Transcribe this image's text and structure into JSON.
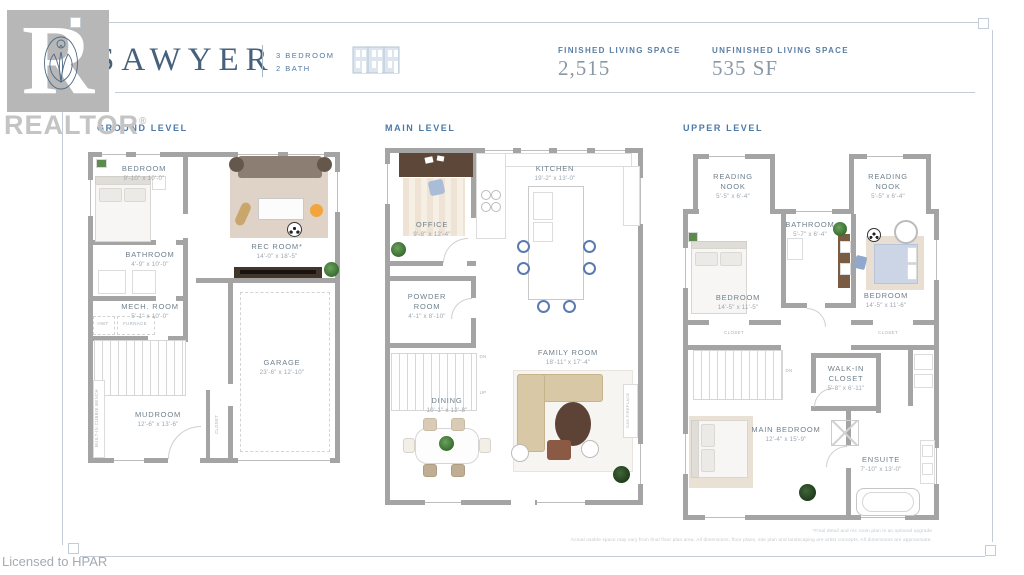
{
  "header": {
    "brand": "SAWYER",
    "bed_label": "3 BEDROOM",
    "bath_label": "2 BATH",
    "finished_label": "FINISHED LIVING SPACE",
    "finished_value": "2,515",
    "unfinished_label": "UNFINISHED LIVING SPACE",
    "unfinished_value": "535 SF"
  },
  "watermark": {
    "realtor": "REALTOR",
    "registered": "®",
    "licensed": "Licensed to HPAR"
  },
  "levels": {
    "ground": {
      "title": "GROUND LEVEL",
      "rooms": {
        "bedroom": {
          "name": "BEDROOM",
          "dims": "9'-10\" x 10'-0\""
        },
        "bathroom": {
          "name": "BATHROOM",
          "dims": "4'-9\" x 10'-0\""
        },
        "mech": {
          "name": "MECH. ROOM",
          "dims": "5'-1\" x 10'-0\""
        },
        "rec": {
          "name": "REC ROOM*",
          "dims": "14'-0\" x 18'-5\""
        },
        "mudroom": {
          "name": "MUDROOM",
          "dims": "12'-6\" x 13'-6\""
        },
        "garage": {
          "name": "GARAGE",
          "dims": "23'-6\" x 12'-10\""
        }
      },
      "ann": {
        "bench": "BUILT-IN CUBBIE BENCH",
        "closet": "CLOSET",
        "hwt": "HWT",
        "furnace": "FURNACE"
      }
    },
    "main": {
      "title": "MAIN LEVEL",
      "rooms": {
        "office": {
          "name": "OFFICE",
          "dims": "9'-8\" x 12'-4\""
        },
        "kitchen": {
          "name": "KITCHEN",
          "dims": "19'-2\" x 13'-0\""
        },
        "powder": {
          "name": "POWDER ROOM",
          "dims": "4'-1\" x 8'-10\""
        },
        "dining": {
          "name": "DINING",
          "dims": "10'-1\" x 12'-8\""
        },
        "family": {
          "name": "FAMILY ROOM",
          "dims": "18'-11\" x 17'-4\""
        }
      },
      "ann": {
        "dn": "DN",
        "up": "UP",
        "fireplace": "GAS FIREPLACE"
      }
    },
    "upper": {
      "title": "UPPER LEVEL",
      "rooms": {
        "nook_left": {
          "name": "READING NOOK",
          "dims": "5'-5\" x 6'-4\""
        },
        "nook_right": {
          "name": "READING NOOK",
          "dims": "5'-5\" x 6'-4\""
        },
        "bathroom": {
          "name": "BATHROOM",
          "dims": "5'-7\" x 6'-4\""
        },
        "bedroom_left": {
          "name": "BEDROOM",
          "dims": "14'-5\" x 11'-5\""
        },
        "bedroom_right": {
          "name": "BEDROOM",
          "dims": "14'-5\" x 11'-6\""
        },
        "walkin": {
          "name": "WALK-IN CLOSET",
          "dims": "5'-8\" x 6'-11\""
        },
        "main_bedroom": {
          "name": "MAIN BEDROOM",
          "dims": "12'-4\" x 15'-9\""
        },
        "ensuite": {
          "name": "ENSUITE",
          "dims": "7'-10\" x 13'-0\""
        }
      },
      "ann": {
        "closet_left": "CLOSET",
        "closet_right": "CLOSET",
        "dn": "DN"
      }
    }
  },
  "footer": {
    "line1": "*Final detail and rec room plan is an optional upgrade",
    "line2": "Actual usable space may vary from final floor plan area. All dimensions, floor plans, site plan and landscaping are artist concepts. All dimensions are approximate."
  },
  "colors": {
    "accent": "#4b7aa6",
    "ink": "#45617c",
    "wall": "#a4a4a4"
  }
}
